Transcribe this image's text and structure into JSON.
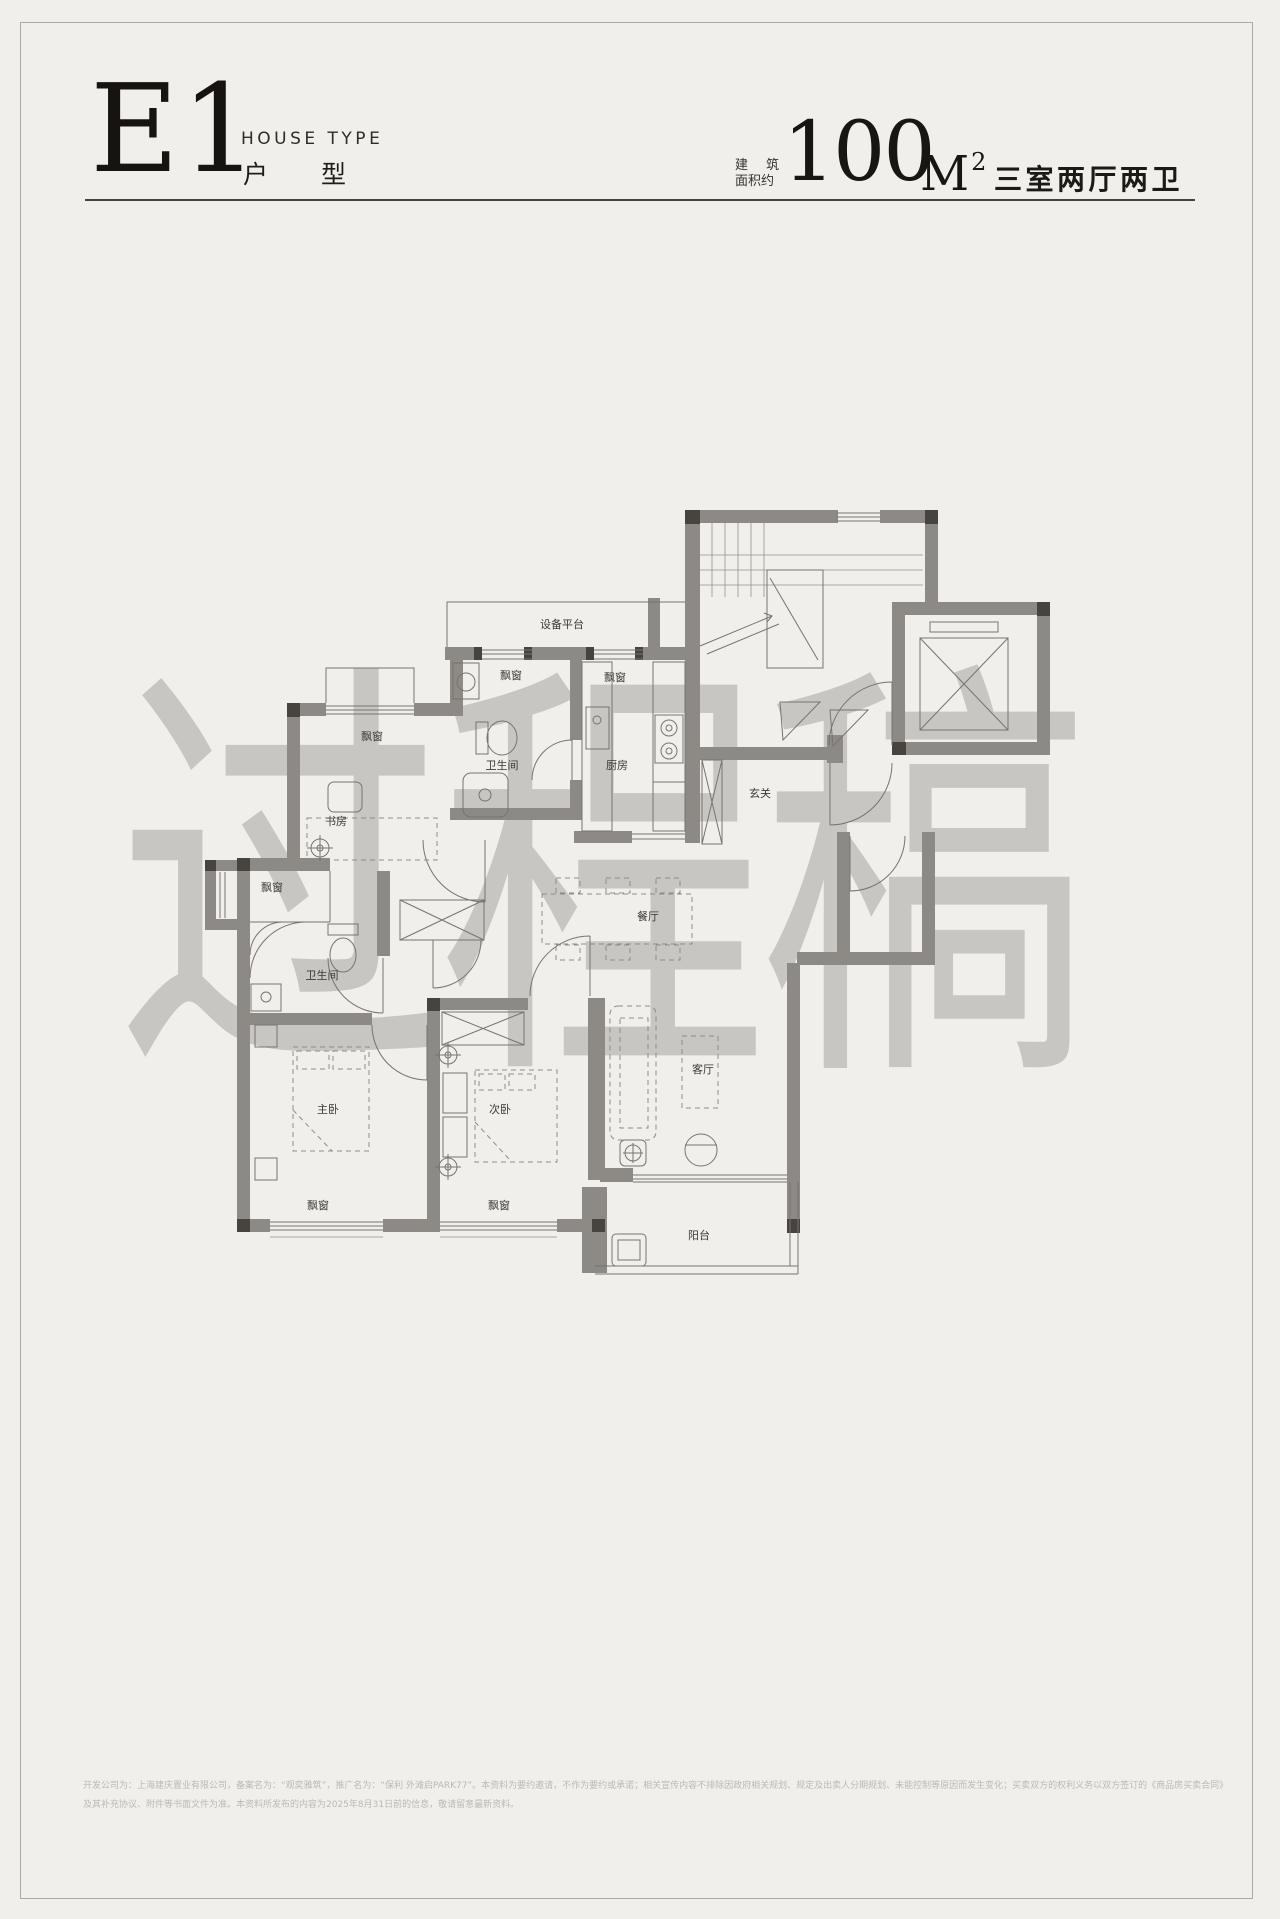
{
  "header": {
    "type_code": "E1",
    "house_type_en": "HOUSE TYPE",
    "house_type_cn_1": "户",
    "house_type_cn_2": "型",
    "area_label_1": "建",
    "area_label_2": "筑",
    "area_label_3": "面积约",
    "area_value": "100",
    "area_unit": "M",
    "area_unit_sup": "2",
    "layout_desc": "三室两厅两卫"
  },
  "watermark": "过程稿",
  "plan": {
    "labels": {
      "equipment_platform": "设备平台",
      "bay_window": "飘窗",
      "bathroom": "卫生间",
      "kitchen": "厨房",
      "foyer": "玄关",
      "study": "书房",
      "dining": "餐厅",
      "master_bedroom": "主卧",
      "second_bedroom": "次卧",
      "living": "客厅",
      "balcony": "阳台"
    }
  },
  "footer": {
    "line1": "开发公司为：上海建庆置业有限公司，备案名为：“观奕雅筑”，推广名为：“保利 外滩启PARK77”。本资料为要约邀请，不作为要约或承诺；相关宣传内容不排除因政府相关规划、规定及出卖人分期规划、未能控制等原因而发生变化；买卖双方的权利义务以双方签订的《商品房买卖合同》",
    "line2": "及其补充协议、附件等书面文件为准。本资料所发布的内容为2025年8月31日前的信息，敬请留意最新资料。"
  },
  "colors": {
    "page_bg": "#f1efec",
    "wall": "#8d8a86",
    "wall_dark": "#474440",
    "thin_line": "#77746f",
    "header_text": "#191612",
    "watermark": "#a8a5a0",
    "footer_text": "#bcb9b4"
  }
}
